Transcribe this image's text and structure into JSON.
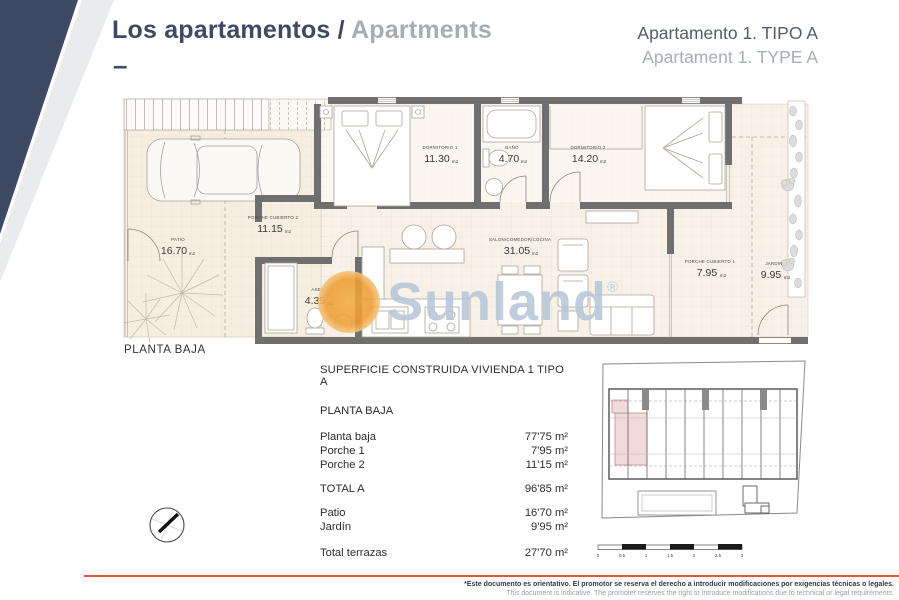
{
  "header": {
    "title_primary": "Los apartamentos /",
    "title_secondary": "Apartments",
    "dash": "–",
    "subtitle_line1": "Apartamento 1. TIPO A",
    "subtitle_line2": "Apartament 1. TYPE A"
  },
  "floor_plan": {
    "caption": "PLANTA BAJA",
    "area_unit": "m2",
    "rooms": [
      {
        "name": "PATIO",
        "area": "16.70"
      },
      {
        "name": "PORCHE CUBIERTO 2",
        "area": "11.15"
      },
      {
        "name": "DORMITORIO 1",
        "area": "11.30"
      },
      {
        "name": "BAÑO",
        "area": "4.70"
      },
      {
        "name": "DORMITORIO 2",
        "area": "14.20"
      },
      {
        "name": "SALON/COMEDOR/COCINA",
        "area": "31.05"
      },
      {
        "name": "ASEO",
        "area": "4.35"
      },
      {
        "name": "PORCHE CUBIERTO 1",
        "area": "7.95"
      },
      {
        "name": "JARDIN",
        "area": "9.95"
      }
    ]
  },
  "watermark": {
    "text": "Sunland",
    "reg": "®"
  },
  "surface_table": {
    "title": "SUPERFICIE CONSTRUIDA VIVIENDA 1 TIPO A",
    "section": "PLANTA BAJA",
    "rows": [
      {
        "label": "Planta baja",
        "value": "77'75 m²"
      },
      {
        "label": "Porche 1",
        "value": "7'95 m²"
      },
      {
        "label": "Porche 2",
        "value": "11'15 m²"
      }
    ],
    "total": {
      "label": "TOTAL A",
      "value": "96'85 m²"
    },
    "outdoor_rows": [
      {
        "label": "Patio",
        "value": "16'70 m²"
      },
      {
        "label": "Jardín",
        "value": "9'95 m²"
      }
    ],
    "terrace_total": {
      "label": "Total terrazas",
      "value": "27'70 m²"
    }
  },
  "scale_bar": {
    "labels": [
      "0",
      "0.5",
      "1",
      "1.5",
      "2",
      "2.5",
      "3"
    ]
  },
  "footer": {
    "line1": "*Este documento es orientativo. El promotor se reserva el derecho a introducir modificaciones por exigencias técnicas o legales.",
    "line2": "This document is indicative. The promoter reserves the right to introduce modifications due to technical or legal requirements."
  },
  "colors": {
    "navy": "#3e4a63",
    "accent_red": "#e4573f",
    "highlight_pink": "#f3d9da",
    "sun_orange": "#ef9d33",
    "watermark_blue": "#b7c7d8",
    "wall_gray": "#6f6f6f",
    "floor_cream": "#f8f1e7"
  }
}
